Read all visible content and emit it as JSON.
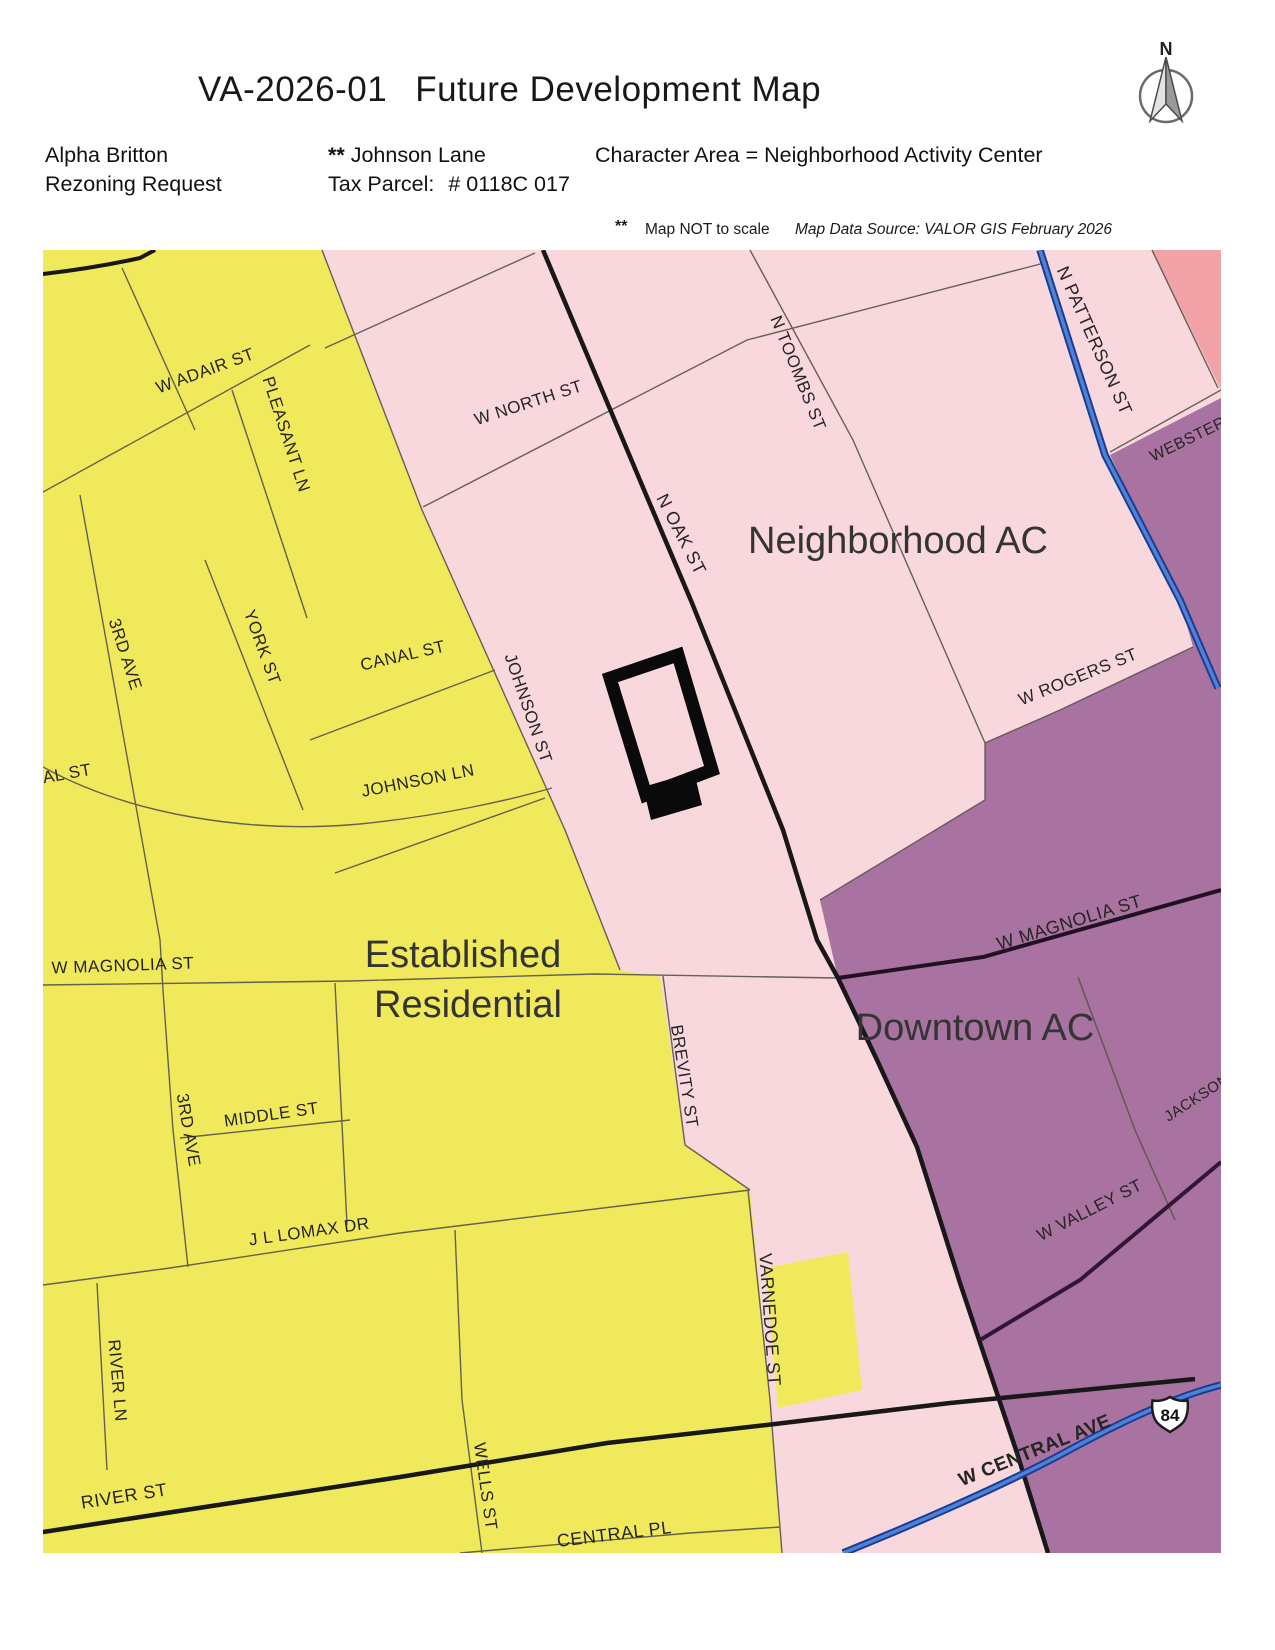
{
  "header": {
    "title_code": "VA-2026-01",
    "title_main": "Future Development Map",
    "applicant": "Alpha Britton",
    "applicant2": "Rezoning Request",
    "marker": "**",
    "location": "Johnson Lane",
    "tax_parcel_label": "Tax Parcel:",
    "tax_parcel_value": "# 0118C  017",
    "character_area": "Character Area  =  Neighborhood Activity Center",
    "note_marker": "**",
    "note_text": "Map NOT to scale",
    "source_text": "Map Data Source:   VALOR GIS  February 2026"
  },
  "compass": {
    "label": "N"
  },
  "map": {
    "colors": {
      "pink": "#f8d8dd",
      "yellow": "#f0e95c",
      "purple": "#a873a0",
      "salmon": "#f2a3a8",
      "blue_core": "#4e82d8",
      "blue_casing": "#1c3c8f",
      "black_road": "#181818",
      "magnolia_road": "#221024",
      "valley_road": "#331636"
    },
    "route_shield": {
      "number": "84"
    },
    "area_labels": [
      {
        "text": "Neighborhood AC",
        "x": 898,
        "y": 553,
        "r": 0,
        "s": 38
      },
      {
        "text": "Established",
        "x": 463,
        "y": 967,
        "r": 0,
        "s": 38
      },
      {
        "text": "Residential",
        "x": 468,
        "y": 1017,
        "r": 0,
        "s": 38
      },
      {
        "text": "Downtown AC",
        "x": 975,
        "y": 1040,
        "r": 0,
        "s": 38
      }
    ],
    "street_labels": [
      {
        "text": "W ADAIR ST",
        "x": 207,
        "y": 376,
        "r": -20,
        "s": 17
      },
      {
        "text": "PLEASANT LN",
        "x": 281,
        "y": 436,
        "r": 72,
        "s": 17
      },
      {
        "text": "W NORTH ST",
        "x": 530,
        "y": 408,
        "r": -18,
        "s": 17
      },
      {
        "text": "N TOOMBS ST",
        "x": 793,
        "y": 375,
        "r": 68,
        "s": 17
      },
      {
        "text": "N OAK ST",
        "x": 676,
        "y": 537,
        "r": 63,
        "s": 18
      },
      {
        "text": "N PATTERSON ST",
        "x": 1089,
        "y": 343,
        "r": 66,
        "s": 18
      },
      {
        "text": "WEBSTER ST",
        "x": 1202,
        "y": 438,
        "r": -26,
        "s": 16
      },
      {
        "text": "W ROGERS ST",
        "x": 1080,
        "y": 682,
        "r": -22,
        "s": 17
      },
      {
        "text": "3RD AVE",
        "x": 120,
        "y": 656,
        "r": 72,
        "s": 17
      },
      {
        "text": "YORK ST",
        "x": 257,
        "y": 649,
        "r": 70,
        "s": 17
      },
      {
        "text": "CANAL ST",
        "x": 404,
        "y": 661,
        "r": -13,
        "s": 17
      },
      {
        "text": "AL ST",
        "x": 68,
        "y": 779,
        "r": -10,
        "s": 17
      },
      {
        "text": "JOHNSON ST",
        "x": 523,
        "y": 710,
        "r": 71,
        "s": 17
      },
      {
        "text": "JOHNSON LN",
        "x": 419,
        "y": 786,
        "r": -11,
        "s": 17
      },
      {
        "text": "W MAGNOLIA ST",
        "x": 123,
        "y": 971,
        "r": -2,
        "s": 17
      },
      {
        "text": "W MAGNOLIA ST",
        "x": 1071,
        "y": 928,
        "r": -17,
        "s": 18
      },
      {
        "text": "BREVITY ST",
        "x": 679,
        "y": 1077,
        "r": 81,
        "s": 17
      },
      {
        "text": "MIDDLE ST",
        "x": 272,
        "y": 1120,
        "r": -8,
        "s": 17
      },
      {
        "text": "3RD AVE",
        "x": 183,
        "y": 1131,
        "r": 80,
        "s": 17
      },
      {
        "text": "J L LOMAX DR",
        "x": 310,
        "y": 1237,
        "r": -8,
        "s": 17
      },
      {
        "text": "RIVER LN",
        "x": 112,
        "y": 1381,
        "r": 85,
        "s": 17
      },
      {
        "text": "RIVER ST",
        "x": 125,
        "y": 1502,
        "r": -9,
        "s": 18
      },
      {
        "text": "WELLS ST",
        "x": 480,
        "y": 1487,
        "r": 82,
        "s": 17
      },
      {
        "text": "VARNEDOE ST",
        "x": 764,
        "y": 1320,
        "r": 86,
        "s": 18
      },
      {
        "text": "CENTRAL PL",
        "x": 615,
        "y": 1540,
        "r": -7,
        "s": 18
      },
      {
        "text": "W VALLEY ST",
        "x": 1092,
        "y": 1215,
        "r": -27,
        "s": 17
      },
      {
        "text": "JACKSON ST",
        "x": 1210,
        "y": 1095,
        "r": -33,
        "s": 15
      },
      {
        "text": "W CENTRAL AVE",
        "x": 1037,
        "y": 1456,
        "r": -22,
        "s": 19,
        "c": "#232c55",
        "w": "bold"
      }
    ]
  }
}
